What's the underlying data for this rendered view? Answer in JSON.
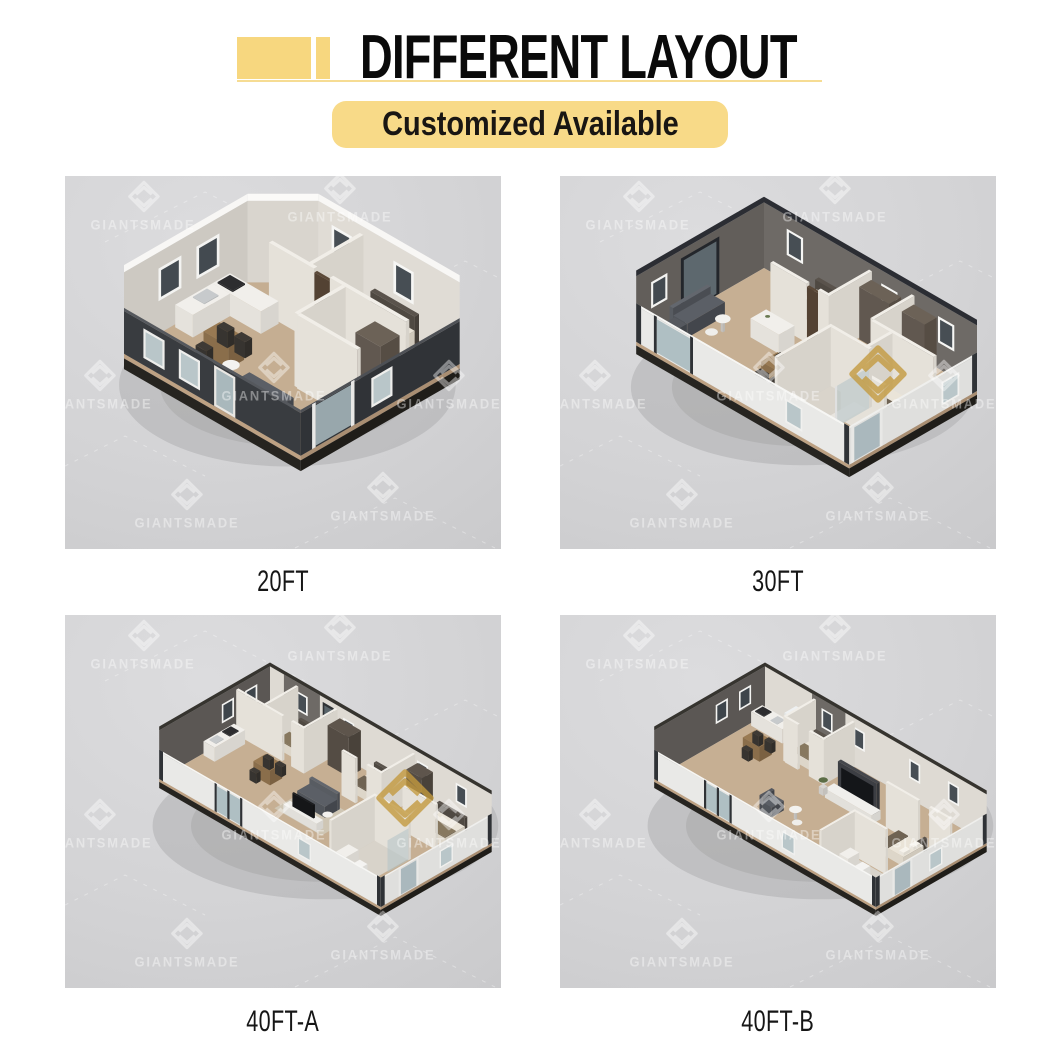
{
  "header": {
    "title": "DIFFERENT LAYOUT",
    "badge": "Customized Available"
  },
  "watermark": {
    "brand": "GIANTSMADE"
  },
  "colors": {
    "accent_yellow": "#F7D77F",
    "badge_yellow": "#F8DA88",
    "underline_yellow": "#F6DC93",
    "title_color": "#0A0A0A",
    "panel_background": "#D3D3D5",
    "watermark_white": "rgba(255,255,255,0.4)",
    "watermark_gold": "#C39A3E"
  },
  "panels": [
    {
      "id": "20ft",
      "label": "20FT"
    },
    {
      "id": "30ft",
      "label": "30FT"
    },
    {
      "id": "40ft-a",
      "label": "40FT-A"
    },
    {
      "id": "40ft-b",
      "label": "40FT-B"
    }
  ]
}
